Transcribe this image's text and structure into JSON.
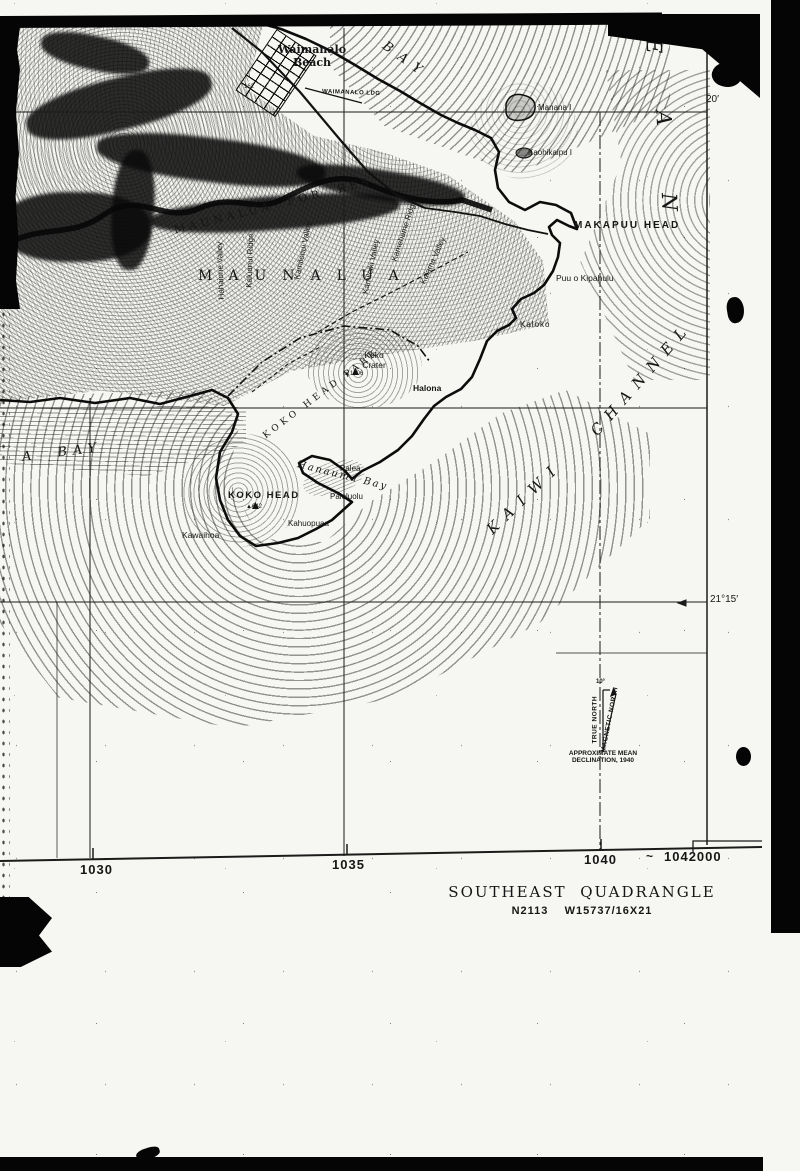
{
  "map": {
    "labels": {
      "waimanalo_beach": "Waimanalo\nBeach",
      "bay": "BAY",
      "waimanalo_ldg": "WAIMANALO LDG",
      "manana": "Manana I",
      "kaohikaipu": "Kaohikaipu I",
      "makapuu_head": "MAKAPUU HEAD",
      "puu_o_kipahulu": "Puu o Kipahulu",
      "kaloko": "Kaloko",
      "koko_crater": "Koko\nCrater",
      "koko_crater_elev": "▲1206",
      "halona": "Halona",
      "palea": "Palea",
      "hanauma_bay": "Hanauma Bay",
      "paioluolu": "Paioluolu",
      "koko_head": "KOKO HEAD",
      "koko_head_elev": "▲642",
      "kahuopuaa": "Kahuopuaa",
      "kawaihoa": "Kawaihoa",
      "koko_head_park": "KOKO HEAD PARK",
      "kaiwi": "KAIWI",
      "channel": "CHANNEL",
      "a_bay": "A  BAY",
      "maunalua": "MAUNALUA",
      "maunalua_for_res": "MAUNALUA  FOR  RES",
      "hahaione_valley": "Hahaione Valley",
      "kaluanui_ridge": "Kaluanui Ridge",
      "kamilonui_valley": "Kamilonui Valley",
      "kamiloiki_valley": "Kamiloiki Valley",
      "kamehame_ridge": "Kamehame Ridge",
      "kalama_valley": "Kalama Valley",
      "spot_162": "162",
      "edge_o": "O",
      "edge_g": "G"
    },
    "ocean_letters": {
      "e": "E",
      "a": "A",
      "n": "N"
    },
    "graticule": {
      "lat_20": "20′",
      "lat_21_15": "21°15′"
    },
    "grid_ticks": {
      "t1030": "1030",
      "t1035": "1035",
      "t1040": "1040",
      "t1042000": "1042000",
      "tilde": "~"
    },
    "declination": {
      "true_north": "TRUE NORTH",
      "magnetic_north": "MAGNETIC NORTH",
      "angle": "10°",
      "caption": "APPROXIMATE MEAN\nDECLINATION, 1940"
    }
  },
  "footer": {
    "quadrangle": "SOUTHEAST  QUADRANGLE",
    "sheet_id": "N2113    W15737/16X21"
  }
}
